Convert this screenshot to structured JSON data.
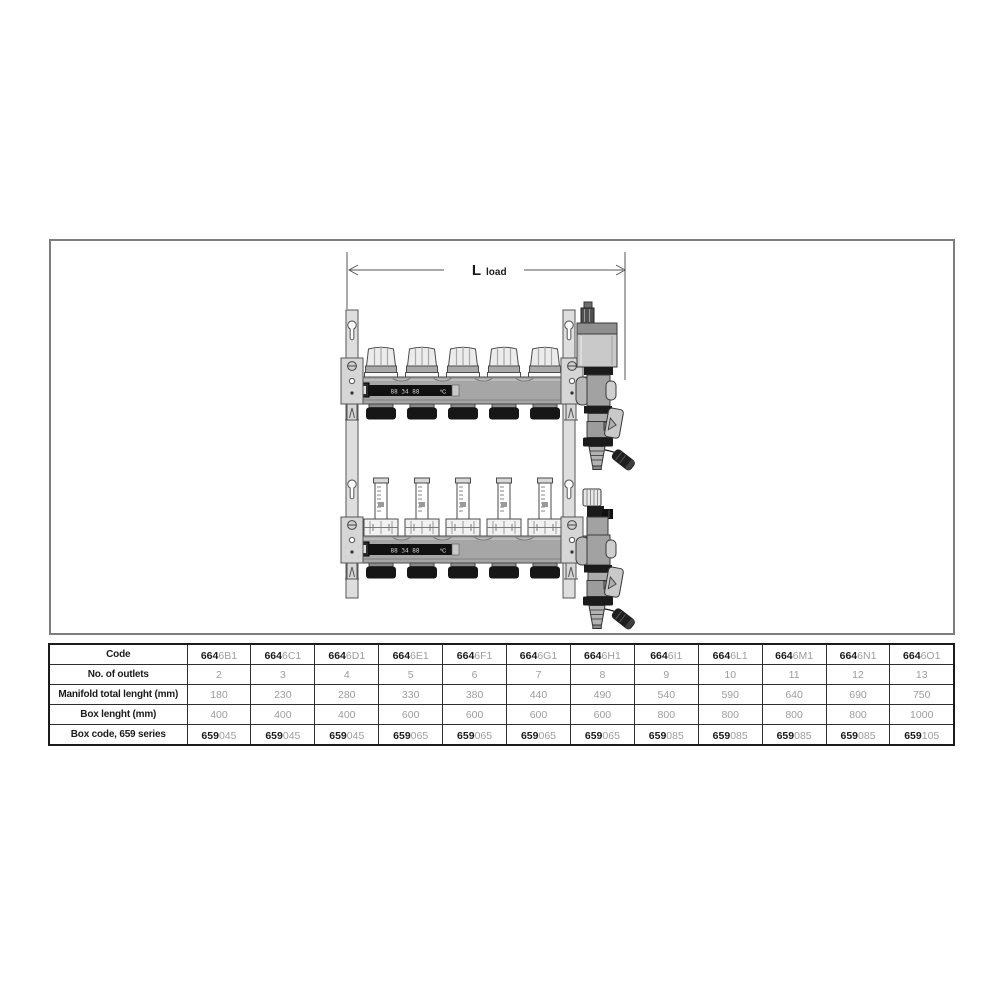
{
  "drawing": {
    "dimension": {
      "label_main": "L",
      "label_sub": "load"
    },
    "display": {
      "digits": "88 34 88",
      "unit": "°C"
    }
  },
  "table": {
    "code_prefix": "664",
    "box_code_prefix": "659",
    "row_labels": [
      "Code",
      "No. of outlets",
      "Manifold total lenght (mm)",
      "Box lenght (mm)",
      "Box code, 659 series"
    ],
    "columns": [
      {
        "code_suffix": "6B1",
        "outlets": "2",
        "manifold_length": "180",
        "box_length": "400",
        "box_code_suffix": "045"
      },
      {
        "code_suffix": "6C1",
        "outlets": "3",
        "manifold_length": "230",
        "box_length": "400",
        "box_code_suffix": "045"
      },
      {
        "code_suffix": "6D1",
        "outlets": "4",
        "manifold_length": "280",
        "box_length": "400",
        "box_code_suffix": "045"
      },
      {
        "code_suffix": "6E1",
        "outlets": "5",
        "manifold_length": "330",
        "box_length": "600",
        "box_code_suffix": "065"
      },
      {
        "code_suffix": "6F1",
        "outlets": "6",
        "manifold_length": "380",
        "box_length": "600",
        "box_code_suffix": "065"
      },
      {
        "code_suffix": "6G1",
        "outlets": "7",
        "manifold_length": "440",
        "box_length": "600",
        "box_code_suffix": "065"
      },
      {
        "code_suffix": "6H1",
        "outlets": "8",
        "manifold_length": "490",
        "box_length": "600",
        "box_code_suffix": "065"
      },
      {
        "code_suffix": "6I1",
        "outlets": "9",
        "manifold_length": "540",
        "box_length": "800",
        "box_code_suffix": "085"
      },
      {
        "code_suffix": "6L1",
        "outlets": "10",
        "manifold_length": "590",
        "box_length": "800",
        "box_code_suffix": "085"
      },
      {
        "code_suffix": "6M1",
        "outlets": "11",
        "manifold_length": "640",
        "box_length": "800",
        "box_code_suffix": "085"
      },
      {
        "code_suffix": "6N1",
        "outlets": "12",
        "manifold_length": "690",
        "box_length": "800",
        "box_code_suffix": "085"
      },
      {
        "code_suffix": "6O1",
        "outlets": "13",
        "manifold_length": "750",
        "box_length": "1000",
        "box_code_suffix": "105"
      }
    ]
  },
  "colors": {
    "table_line": "#2e2e2e",
    "muted_text": "#9c9c9c",
    "dark_text": "#1b1b1b",
    "panel_border": "#7d7d7d",
    "metal_light": "#ececec",
    "metal_mid": "#a6a6a6",
    "metal_dark": "#1b1b1b"
  }
}
